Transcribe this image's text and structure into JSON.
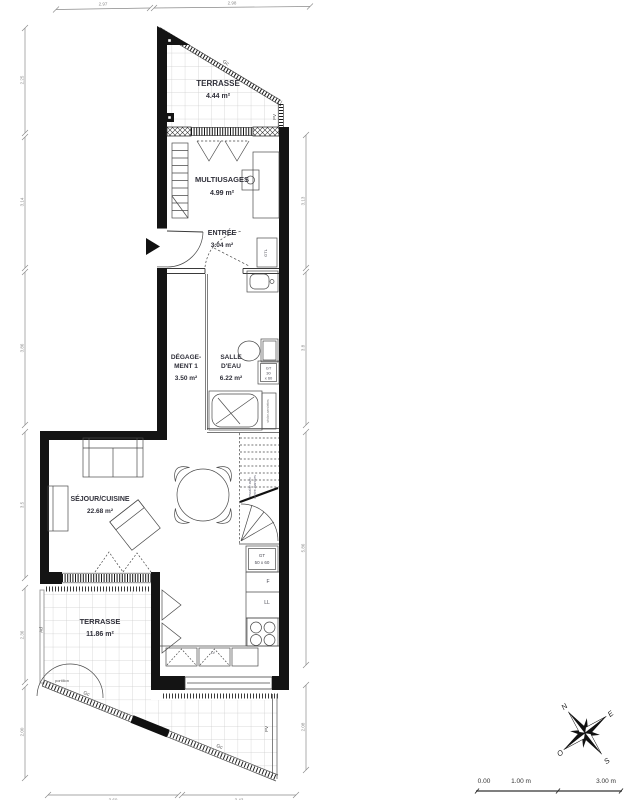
{
  "rooms": {
    "terrace_top": {
      "name": "TERRASSE",
      "area": "4.44 m²"
    },
    "multiusages": {
      "name": "MULTIUSAGES",
      "area": "4.99 m²"
    },
    "entree": {
      "name": "ENTRÉE",
      "area": "3.04 m²"
    },
    "degagement": {
      "name_line1": "DÉGAGE-",
      "name_line2": "MENT 1",
      "area": "3.50 m²"
    },
    "salle_eau": {
      "name_line1": "SALLE",
      "name_line2": "D'EAU",
      "area": "6.22 m²"
    },
    "sejour_cuisine": {
      "name": "SÉJOUR/CUISINE",
      "area": "22.68 m²"
    },
    "terrace_bottom": {
      "name": "TERRASSE",
      "area": "11.86 m²"
    }
  },
  "labels": {
    "gc_top": "Gc",
    "pv_top": "PV",
    "gtl": "GTL",
    "gt30_l1": "GT",
    "gt30_l2": "30",
    "gt30_l3": "x 60",
    "gt50_l1": "GT",
    "gt50_l2": "50 x 60",
    "fridge": "F",
    "washing_machine": "LL",
    "dishwasher": "LV",
    "towel_rail": "sèche-serviettes",
    "stairs_l1": "escalier avec",
    "stairs_l2": "contre-marches",
    "ad": "Ad",
    "portillon": "portillon",
    "gc_bottom1": "Gc",
    "gc_bottom2": "Gc",
    "pv_bottom": "PV"
  },
  "dimensions": {
    "top": [
      "2.97",
      "2.98"
    ],
    "left": [
      "2.25",
      "3.14",
      "3.86",
      "3.5",
      "2.36",
      "2.00"
    ],
    "right": [
      "3.13",
      "3.8",
      "5.86",
      "2.08"
    ],
    "bottom": [
      "3.60",
      "3.43"
    ]
  },
  "compass": {
    "n": "N",
    "e": "E",
    "s": "S",
    "w": "O"
  },
  "scale_bar": {
    "zero": "0.00",
    "one": "1.00 m",
    "three": "3.00 m"
  },
  "colors": {
    "wall": "#141414",
    "tile_grid": "#cccccc",
    "dim": "#8a8a8a",
    "accent_red": "#b3342e"
  }
}
